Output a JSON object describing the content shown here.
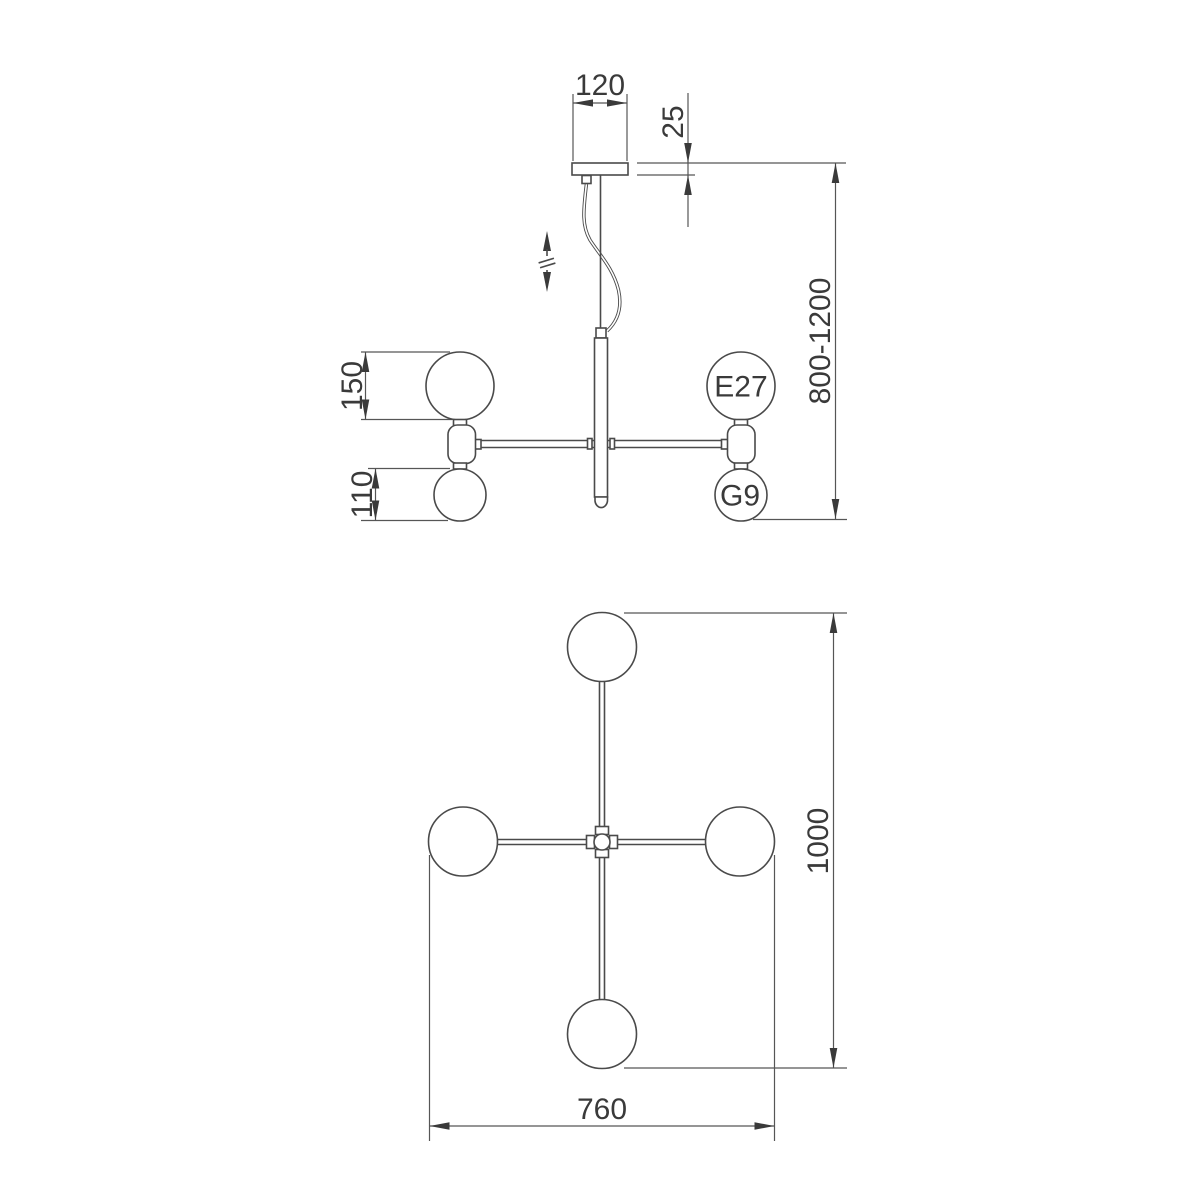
{
  "title": "Pendant chandelier technical dimension drawing",
  "colors": {
    "background": "#ffffff",
    "line": "#4a4a4a",
    "dimension_line": "#565656",
    "text": "#3a3a3a"
  },
  "side_view": {
    "dim_canopy_width": "120",
    "dim_canopy_height": "25",
    "dim_height_range": "800-1200",
    "dim_large_globe": "150",
    "dim_small_globe": "110",
    "label_socket_large": "E27",
    "label_socket_small": "G9"
  },
  "plan_view": {
    "dim_length": "1000",
    "dim_width": "760"
  }
}
